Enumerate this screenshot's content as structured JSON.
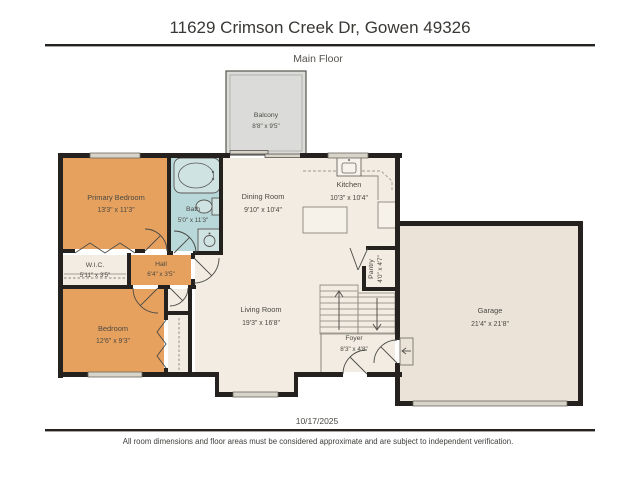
{
  "header": {
    "title": "11629 Crimson Creek Dr, Gowen 49326",
    "floor_label": "Main Floor"
  },
  "footer": {
    "date": "10/17/2025",
    "disclaimer": "All room dimensions and floor areas must be considered approximate and are subject to independent verification."
  },
  "rooms": {
    "balcony": {
      "name": "Balcony",
      "dims": "8'8\" x 9'5\""
    },
    "primary_bedroom": {
      "name": "Primary Bedroom",
      "dims": "13'3\" x 11'3\""
    },
    "bath": {
      "name": "Bath",
      "dims": "5'0\" x 11'3\""
    },
    "dining_room": {
      "name": "Dining Room",
      "dims": "9'10\" x 10'4\""
    },
    "kitchen": {
      "name": "Kitchen",
      "dims": "10'3\" x 10'4\""
    },
    "wic": {
      "name": "W.I.C.",
      "dims": "5'11\" x 3'5\""
    },
    "hall": {
      "name": "Hall",
      "dims": "6'4\" x 3'5\""
    },
    "bedroom": {
      "name": "Bedroom",
      "dims": "12'6\" x 9'3\""
    },
    "living_room": {
      "name": "Living Room",
      "dims": "19'3\" x 16'8\""
    },
    "pantry": {
      "name": "Pantry",
      "dims": "4'0\" x 4'7\""
    },
    "foyer": {
      "name": "Foyer",
      "dims": "8'3\" x 4'8\""
    },
    "garage": {
      "name": "Garage",
      "dims": "21'4\" x 21'8\""
    }
  },
  "colors": {
    "wall": "#24211f",
    "bedroom_fill": "#e7a15e",
    "bath_fill": "#b9d8da",
    "floor_fill": "#f2ece2",
    "garage_fill": "#ebe3d8",
    "balcony_fill": "#dbdbd9",
    "window_fill": "#d8d4ca"
  }
}
